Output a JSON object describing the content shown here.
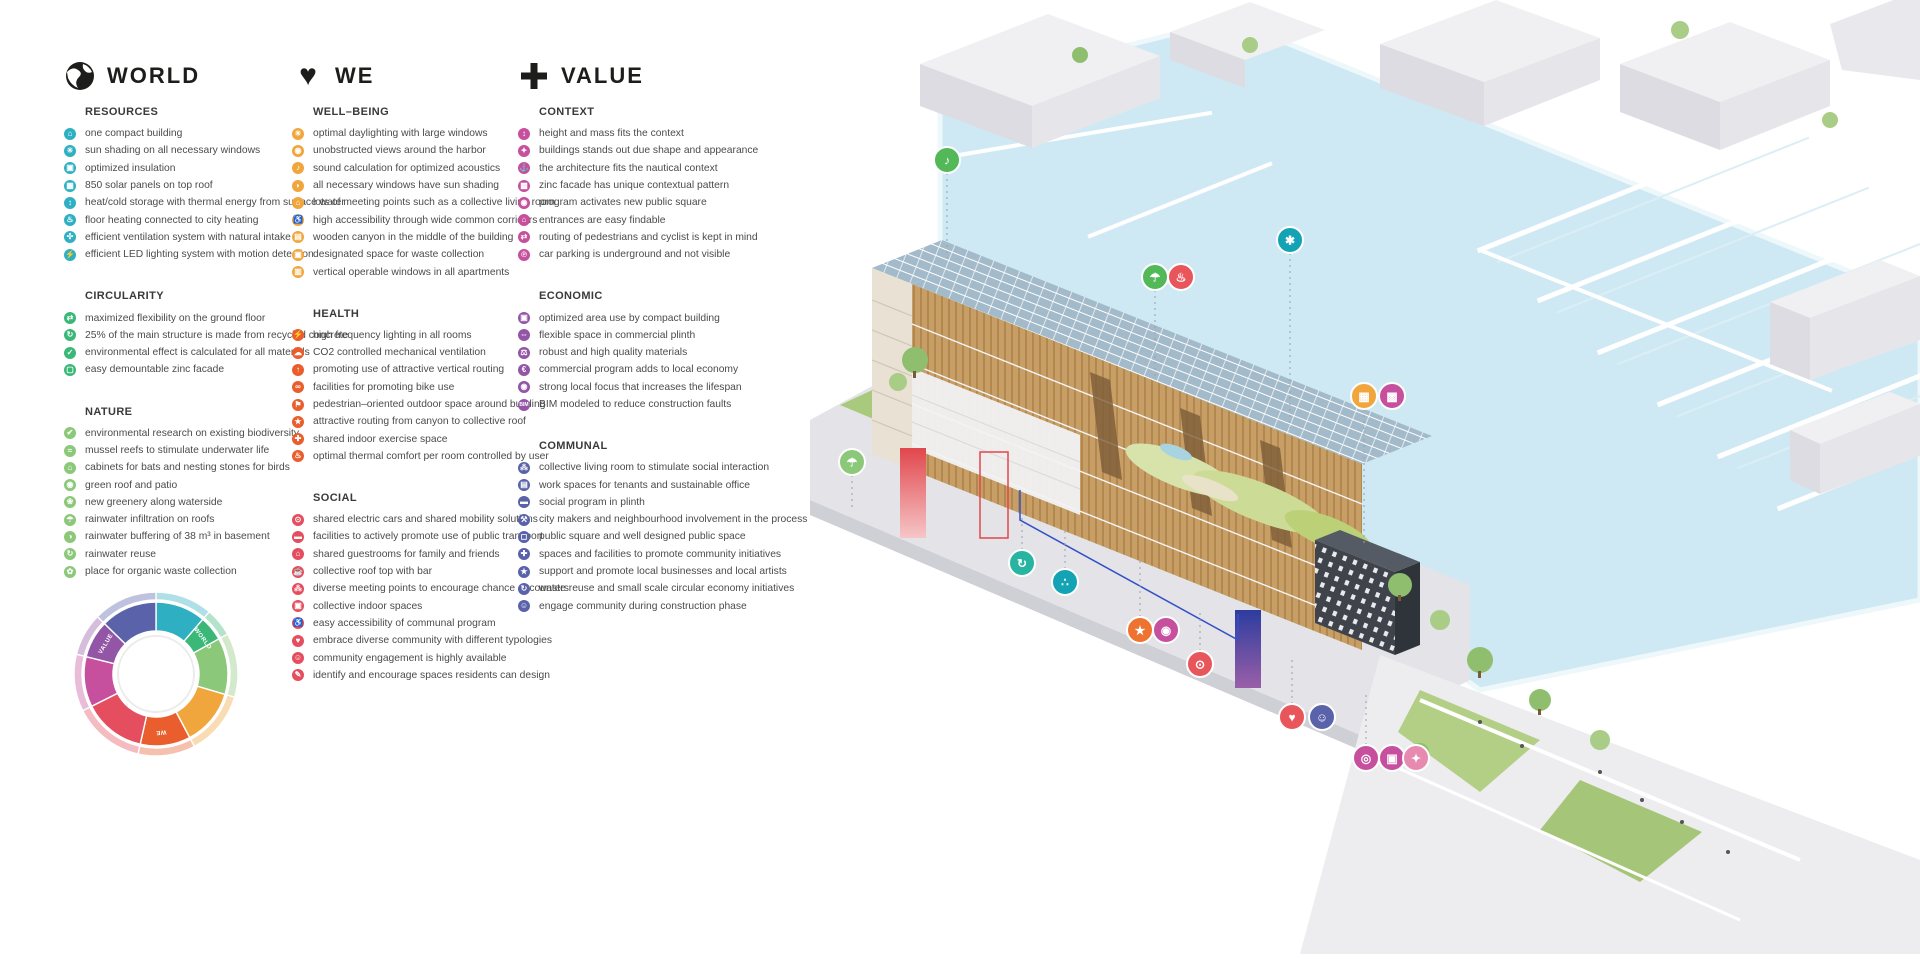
{
  "columns": [
    {
      "id": "world",
      "title": "WORLD",
      "icon": "globe-icon",
      "sections": [
        {
          "title": "RESOURCES",
          "color": "#2fb0c2",
          "items": [
            {
              "glyph": "⌂",
              "text": "one compact building"
            },
            {
              "glyph": "☀",
              "text": "sun shading on all necessary windows"
            },
            {
              "glyph": "▣",
              "text": "optimized insulation"
            },
            {
              "glyph": "▦",
              "text": "850 solar panels on top roof"
            },
            {
              "glyph": "↕",
              "text": "heat/cold storage with thermal energy from surface water"
            },
            {
              "glyph": "♨",
              "text": "floor heating connected to city heating"
            },
            {
              "glyph": "✣",
              "text": "efficient ventilation system with natural intake"
            },
            {
              "glyph": "⚡",
              "text": "efficient LED lighting system with motion detection"
            }
          ]
        },
        {
          "title": "CIRCULARITY",
          "color": "#3bb878",
          "items": [
            {
              "glyph": "⇄",
              "text": "maximized flexibility on the ground floor"
            },
            {
              "glyph": "↻",
              "text": "25% of the main structure is made from recycled concrete"
            },
            {
              "glyph": "✓",
              "text": "environmental effect is calculated for all materials"
            },
            {
              "glyph": "▢",
              "text": "easy demountable zinc facade"
            }
          ]
        },
        {
          "title": "NATURE",
          "color": "#8cc879",
          "items": [
            {
              "glyph": "✔",
              "text": "environmental research on existing biodiversity"
            },
            {
              "glyph": "≈",
              "text": "mussel reefs to stimulate underwater life"
            },
            {
              "glyph": "⌂",
              "text": "cabinets for bats and nesting stones for birds"
            },
            {
              "glyph": "◉",
              "text": "green roof and patio"
            },
            {
              "glyph": "❀",
              "text": "new greenery along waterside"
            },
            {
              "glyph": "☂",
              "text": "rainwater infiltration on roofs"
            },
            {
              "glyph": "◑",
              "text": "rainwater buffering of 38 m³ in basement"
            },
            {
              "glyph": "↻",
              "text": "rainwater reuse"
            },
            {
              "glyph": "✿",
              "text": "place for organic waste collection"
            }
          ]
        }
      ]
    },
    {
      "id": "we",
      "title": "WE",
      "icon": "heart-icon",
      "sections": [
        {
          "title": "WELL–BEING",
          "color": "#f0a63c",
          "items": [
            {
              "glyph": "☀",
              "text": "optimal daylighting with large windows"
            },
            {
              "glyph": "◉",
              "text": "unobstructed views around the harbor"
            },
            {
              "glyph": "♪",
              "text": "sound calculation for optimized acoustics"
            },
            {
              "glyph": "◗",
              "text": "all necessary windows have sun shading"
            },
            {
              "glyph": "⌂",
              "text": "lots of meeting points such as a collective living room"
            },
            {
              "glyph": "♿",
              "text": "high accessibility through wide common corridors"
            },
            {
              "glyph": "▤",
              "text": "wooden canyon in the middle of the building"
            },
            {
              "glyph": "▣",
              "text": "designated space for waste collection"
            },
            {
              "glyph": "▥",
              "text": "vertical operable windows in all apartments"
            }
          ]
        },
        {
          "title": "HEALTH",
          "color": "#ea5d2c",
          "items": [
            {
              "glyph": "⚡",
              "text": "high frequency lighting in all rooms"
            },
            {
              "glyph": "☁",
              "text": "CO2 controlled mechanical ventilation"
            },
            {
              "glyph": "↑",
              "text": "promoting use of attractive vertical routing"
            },
            {
              "glyph": "∞",
              "text": "facilities for promoting bike use"
            },
            {
              "glyph": "⚑",
              "text": "pedestrian–oriented outdoor space around building"
            },
            {
              "glyph": "★",
              "text": "attractive routing from canyon to collective roof"
            },
            {
              "glyph": "✚",
              "text": "shared indoor exercise space"
            },
            {
              "glyph": "♨",
              "text": "optimal thermal comfort per room controlled by user"
            }
          ]
        },
        {
          "title": "SOCIAL",
          "color": "#e44e5e",
          "items": [
            {
              "glyph": "⊙",
              "text": "shared electric cars and shared mobility solutions"
            },
            {
              "glyph": "▬",
              "text": "facilities to actively promote use of public transport"
            },
            {
              "glyph": "⌂",
              "text": "shared guestrooms for family and friends"
            },
            {
              "glyph": "☕",
              "text": "collective roof top with bar"
            },
            {
              "glyph": "⁂",
              "text": "diverse meeting points to encourage chance encounters"
            },
            {
              "glyph": "▣",
              "text": "collective indoor spaces"
            },
            {
              "glyph": "♿",
              "text": "easy accessibility of communal program"
            },
            {
              "glyph": "♥",
              "text": "embrace diverse community with different typologies"
            },
            {
              "glyph": "☺",
              "text": "community engagement is highly available"
            },
            {
              "glyph": "✎",
              "text": "identify and encourage spaces residents can design"
            }
          ]
        }
      ]
    },
    {
      "id": "value",
      "title": "VALUE",
      "icon": "plus-icon",
      "sections": [
        {
          "title": "CONTEXT",
          "color": "#c6509e",
          "items": [
            {
              "glyph": "↕",
              "text": "height and mass fits the context"
            },
            {
              "glyph": "✦",
              "text": "buildings stands out due shape and appearance"
            },
            {
              "glyph": "⚓",
              "text": "the architecture fits the nautical context"
            },
            {
              "glyph": "▩",
              "text": "zinc facade has unique contextual pattern"
            },
            {
              "glyph": "◉",
              "text": "program activates new public square"
            },
            {
              "glyph": "⌂",
              "text": "entrances are easy findable"
            },
            {
              "glyph": "⇄",
              "text": "routing of pedestrians and cyclist is kept in mind"
            },
            {
              "glyph": "℗",
              "text": "car parking is underground and not visible"
            }
          ]
        },
        {
          "title": "ECONOMIC",
          "color": "#9355a5",
          "items": [
            {
              "glyph": "▣",
              "text": "optimized area use by compact building"
            },
            {
              "glyph": "⇔",
              "text": "flexible space in commercial plinth"
            },
            {
              "glyph": "⚖",
              "text": "robust and high quality materials"
            },
            {
              "glyph": "€",
              "text": "commercial program adds to local economy"
            },
            {
              "glyph": "◉",
              "text": "strong local focus that increases the lifespan"
            },
            {
              "glyph": "BIM",
              "text": "BIM modeled to reduce construction faults"
            }
          ]
        },
        {
          "title": "COMMUNAL",
          "color": "#5a62aa",
          "items": [
            {
              "glyph": "⁂",
              "text": "collective living room to stimulate social interaction"
            },
            {
              "glyph": "▤",
              "text": "work spaces for tenants and sustainable office"
            },
            {
              "glyph": "▬",
              "text": "social program in plinth"
            },
            {
              "glyph": "⚒",
              "text": "city makers and neighbourhood involvement in the process"
            },
            {
              "glyph": "◻",
              "text": "public square and well designed public space"
            },
            {
              "glyph": "✚",
              "text": "spaces and facilities to promote community initiatives"
            },
            {
              "glyph": "★",
              "text": "support and promote local businesses and local artists"
            },
            {
              "glyph": "↻",
              "text": "waste reuse and small scale circular economy initiatives"
            },
            {
              "glyph": "☺",
              "text": "engage community during construction phase"
            }
          ]
        }
      ]
    }
  ],
  "wheel": {
    "labels": [
      "WORLD",
      "WE",
      "VALUE"
    ],
    "segments": [
      {
        "name": "resources",
        "color": "#2fb0c2",
        "count": 8
      },
      {
        "name": "circularity",
        "color": "#3bb878",
        "count": 4
      },
      {
        "name": "nature",
        "color": "#8cc879",
        "count": 9
      },
      {
        "name": "well-being",
        "color": "#f0a63c",
        "count": 9
      },
      {
        "name": "health",
        "color": "#ea5d2c",
        "count": 8
      },
      {
        "name": "social",
        "color": "#e44e5e",
        "count": 10
      },
      {
        "name": "context",
        "color": "#c6509e",
        "count": 8
      },
      {
        "name": "economic",
        "color": "#9355a5",
        "count": 6
      },
      {
        "name": "communal",
        "color": "#5a62aa",
        "count": 9
      }
    ]
  },
  "illustration": {
    "badges": [
      {
        "name": "bird-icon",
        "x": 167,
        "y": 160,
        "color": "#52b858",
        "glyph": "♪",
        "lead": 85
      },
      {
        "name": "wand-icon",
        "x": 510,
        "y": 240,
        "color": "#14a3b4",
        "glyph": "✱",
        "lead": 175
      },
      {
        "name": "shower-icon",
        "x": 375,
        "y": 277,
        "color": "#52b858",
        "glyph": "☂",
        "lead": 90
      },
      {
        "name": "heat-icon",
        "x": 401,
        "y": 277,
        "color": "#e8565c",
        "glyph": "♨",
        "lead": 0
      },
      {
        "name": "window-icon",
        "x": 584,
        "y": 396,
        "color": "#f0a63c",
        "glyph": "▦",
        "lead": 135
      },
      {
        "name": "pattern-icon",
        "x": 612,
        "y": 396,
        "color": "#c6509e",
        "glyph": "▩",
        "lead": 0
      },
      {
        "name": "rain-icon",
        "x": 72,
        "y": 462,
        "color": "#8cc879",
        "glyph": "☂",
        "lead": 32
      },
      {
        "name": "recycle-icon",
        "x": 242,
        "y": 563,
        "color": "#27b4a0",
        "glyph": "↻",
        "lead": -40
      },
      {
        "name": "drops-icon",
        "x": 285,
        "y": 582,
        "color": "#14a3b4",
        "glyph": "∴",
        "lead": -42
      },
      {
        "name": "star-icon",
        "x": 360,
        "y": 630,
        "color": "#ee7330",
        "glyph": "★",
        "lead": -58
      },
      {
        "name": "map-icon",
        "x": 386,
        "y": 630,
        "color": "#c6509e",
        "glyph": "◉",
        "lead": 0
      },
      {
        "name": "car-icon",
        "x": 420,
        "y": 664,
        "color": "#e8565c",
        "glyph": "⊙",
        "lead": -40
      },
      {
        "name": "heart-icon",
        "x": 512,
        "y": 717,
        "color": "#e8565c",
        "glyph": "♥",
        "lead": -48
      },
      {
        "name": "people-icon",
        "x": 542,
        "y": 717,
        "color": "#5a62aa",
        "glyph": "☺",
        "lead": 0
      },
      {
        "name": "pin-icon",
        "x": 586,
        "y": 758,
        "color": "#c6509e",
        "glyph": "◎",
        "lead": -50
      },
      {
        "name": "gift-icon",
        "x": 612,
        "y": 758,
        "color": "#c6509e",
        "glyph": "▣",
        "lead": 0
      },
      {
        "name": "walk-icon",
        "x": 636,
        "y": 758,
        "color": "#e78ab0",
        "glyph": "✦",
        "lead": 0
      }
    ]
  }
}
